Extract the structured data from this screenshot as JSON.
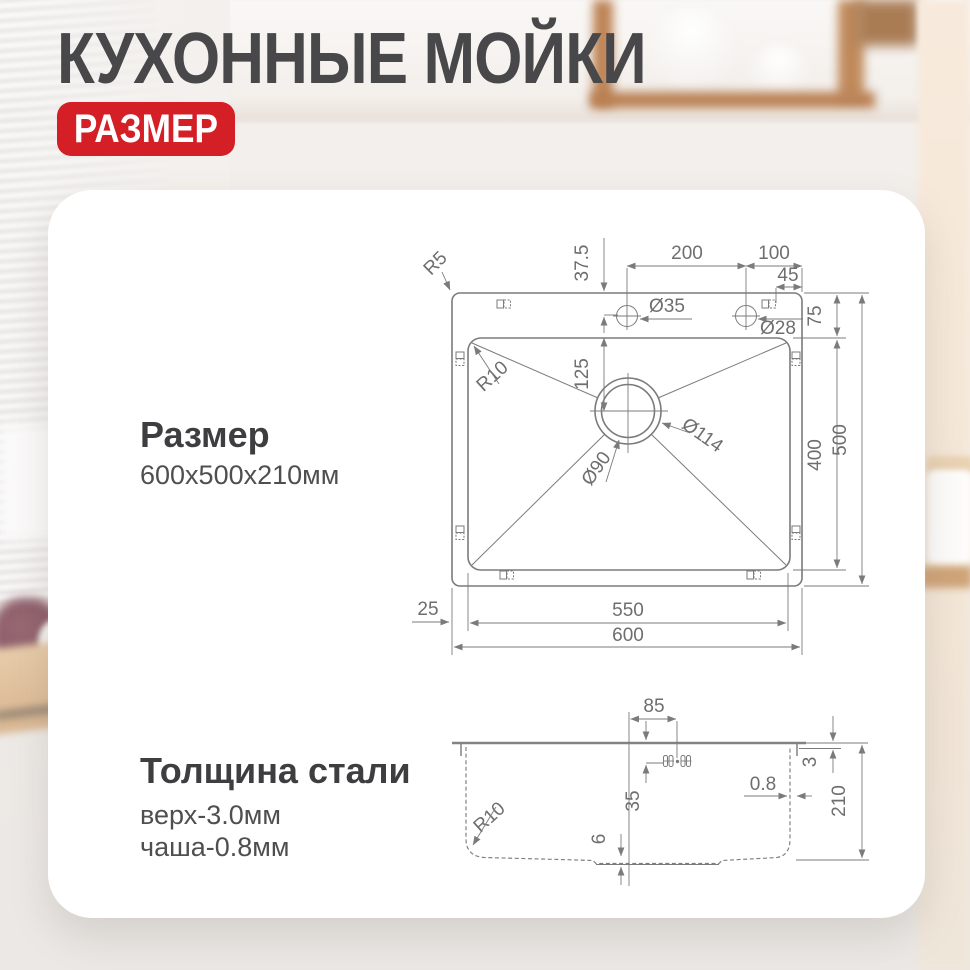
{
  "header": {
    "title": "КУХОННЫЕ МОЙКИ",
    "badge": "РАЗМЕР"
  },
  "sections": {
    "size": {
      "heading": "Размер",
      "value": "600х500х210мм"
    },
    "steel": {
      "heading": "Толщина стали",
      "top": "верх-3.0мм",
      "bowl": "чаша-0.8мм"
    }
  },
  "top_view": {
    "labels": {
      "r5": "R5",
      "r10": "R10",
      "d37_5": "37.5",
      "d200": "200",
      "d100": "100",
      "d45": "45",
      "dia35": "Ø35",
      "dia28": "Ø28",
      "d75": "75",
      "d125": "125",
      "dia90": "Ø90",
      "dia114": "Ø114",
      "d400": "400",
      "d500": "500",
      "d25": "25",
      "d550": "550",
      "d600": "600"
    }
  },
  "side_view": {
    "labels": {
      "d85": "85",
      "d3": "3",
      "d35": "35",
      "d0_8": "0.8",
      "r10": "R10",
      "d6": "6",
      "d210": "210"
    }
  },
  "colors": {
    "accent": "#d41f26",
    "title": "#48484a",
    "line": "#7b7b7b",
    "dim_text": "#6e6e6e"
  }
}
